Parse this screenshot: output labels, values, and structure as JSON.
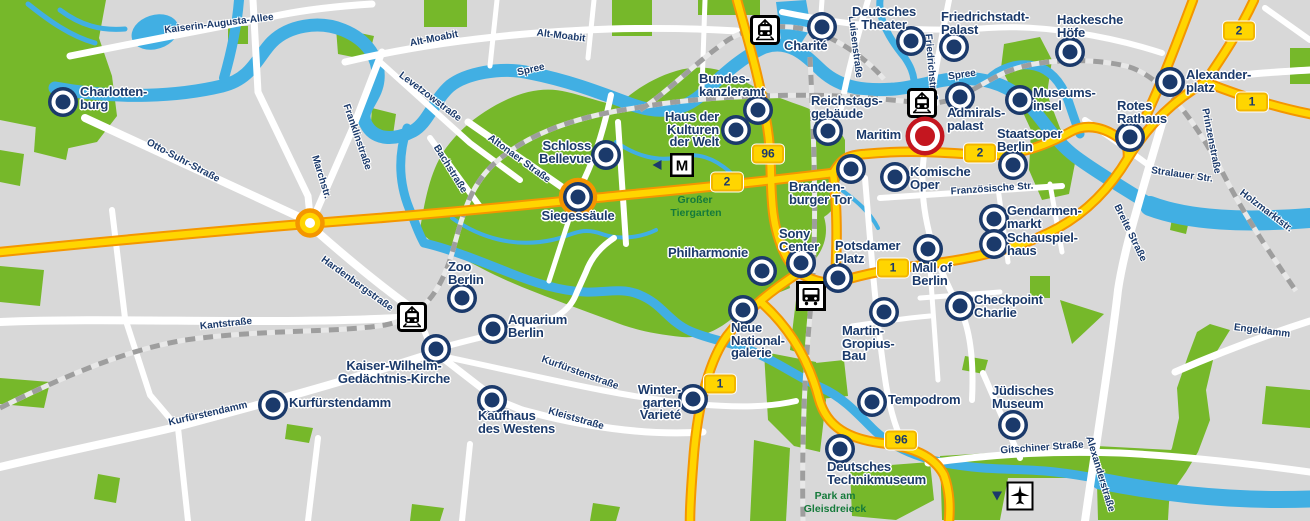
{
  "map": {
    "title": "Berlin city sightseeing map",
    "width": 1310,
    "height": 521
  },
  "colors": {
    "background": "#d8d8d8",
    "park": "#76b82a",
    "water": "#41afe3",
    "road_fill": "#ffd500",
    "road_casing": "#f49600",
    "street": "#ffffff",
    "railway": "#9e9e9e",
    "marker": "#1b3a6b",
    "marker_highlight": "#c4161f",
    "label_text": "#1b3a6b",
    "park_label": "#157a3b",
    "badge_fill": "#ffd500"
  },
  "pois": [
    {
      "id": "charlottenburg",
      "lines": [
        "Charlotten-",
        "burg"
      ],
      "marker": [
        63,
        102
      ],
      "label": [
        80,
        86
      ],
      "anchor": "left",
      "highlight": false
    },
    {
      "id": "schloss-bellevue",
      "lines": [
        "Schloss",
        "Bellevue"
      ],
      "marker": [
        606,
        155
      ],
      "label": [
        591,
        140
      ],
      "anchor": "right",
      "highlight": false
    },
    {
      "id": "siegessaeule",
      "lines": [
        "Siegessäule"
      ],
      "marker": [
        578,
        197
      ],
      "label": [
        578,
        210
      ],
      "anchor": "center",
      "highlight": false
    },
    {
      "id": "haus-der-kulturen-der-welt",
      "lines": [
        "Haus der",
        "Kulturen",
        "der Welt"
      ],
      "marker": [
        736,
        130
      ],
      "label": [
        719,
        111
      ],
      "anchor": "right",
      "highlight": false
    },
    {
      "id": "bundeskanzleramt",
      "lines": [
        "Bundes-",
        "kanzleramt"
      ],
      "marker": [
        758,
        110
      ],
      "label": [
        699,
        73
      ],
      "anchor": "left",
      "highlight": false
    },
    {
      "id": "charite",
      "lines": [
        "Charité"
      ],
      "marker": [
        822,
        27
      ],
      "label": [
        784,
        40
      ],
      "anchor": "left",
      "highlight": false
    },
    {
      "id": "deutsches-theater",
      "lines": [
        "Deutsches",
        "Theater"
      ],
      "marker": [
        911,
        41
      ],
      "label": [
        884,
        6
      ],
      "anchor": "center",
      "highlight": false
    },
    {
      "id": "friedrichstadt-palast",
      "lines": [
        "Friedrichstadt-",
        "Palast"
      ],
      "marker": [
        954,
        47
      ],
      "label": [
        941,
        11
      ],
      "anchor": "left",
      "highlight": false
    },
    {
      "id": "hackesche-hoefe",
      "lines": [
        "Hackesche",
        "Höfe"
      ],
      "marker": [
        1070,
        52
      ],
      "label": [
        1057,
        14
      ],
      "anchor": "left",
      "highlight": false
    },
    {
      "id": "reichstagsgebaeude",
      "lines": [
        "Reichstags-",
        "gebäude"
      ],
      "marker": [
        828,
        131
      ],
      "label": [
        811,
        95
      ],
      "anchor": "left",
      "highlight": false
    },
    {
      "id": "admiralspalast",
      "lines": [
        "Admirals-",
        "palast"
      ],
      "marker": [
        960,
        97
      ],
      "label": [
        947,
        107
      ],
      "anchor": "left",
      "highlight": false
    },
    {
      "id": "museumsinsel",
      "lines": [
        "Museums-",
        "insel"
      ],
      "marker": [
        1020,
        100
      ],
      "label": [
        1033,
        87
      ],
      "anchor": "left",
      "highlight": false
    },
    {
      "id": "maritim",
      "lines": [
        "Maritim"
      ],
      "marker": [
        925,
        136
      ],
      "label": [
        901,
        129
      ],
      "anchor": "right",
      "highlight": true
    },
    {
      "id": "staatsoper-berlin",
      "lines": [
        "Staatsoper",
        "Berlin"
      ],
      "marker": [
        1013,
        165
      ],
      "label": [
        997,
        128
      ],
      "anchor": "left",
      "highlight": false
    },
    {
      "id": "alexanderplatz",
      "lines": [
        "Alexander-",
        "platz"
      ],
      "marker": [
        1170,
        82
      ],
      "label": [
        1186,
        69
      ],
      "anchor": "left",
      "highlight": false
    },
    {
      "id": "rotes-rathaus",
      "lines": [
        "Rotes",
        "Rathaus"
      ],
      "marker": [
        1130,
        137
      ],
      "label": [
        1117,
        100
      ],
      "anchor": "left",
      "highlight": false
    },
    {
      "id": "brandenburger-tor",
      "lines": [
        "Branden-",
        "burger Tor"
      ],
      "marker": [
        851,
        169
      ],
      "label": [
        789,
        181
      ],
      "anchor": "left",
      "highlight": false
    },
    {
      "id": "komische-oper",
      "lines": [
        "Komische",
        "Oper"
      ],
      "marker": [
        895,
        177
      ],
      "label": [
        910,
        166
      ],
      "anchor": "left",
      "highlight": false
    },
    {
      "id": "gendarmenmarkt",
      "lines": [
        "Gendarmen-",
        "markt"
      ],
      "marker": [
        994,
        219
      ],
      "label": [
        1007,
        205
      ],
      "anchor": "left",
      "highlight": false
    },
    {
      "id": "schauspielhaus",
      "lines": [
        "Schauspiel-",
        "haus"
      ],
      "marker": [
        994,
        244
      ],
      "label": [
        1007,
        232
      ],
      "anchor": "left",
      "highlight": false
    },
    {
      "id": "sony-center",
      "lines": [
        "Sony",
        "Center"
      ],
      "marker": [
        801,
        263
      ],
      "label": [
        779,
        228
      ],
      "anchor": "left",
      "highlight": false
    },
    {
      "id": "philharmonie",
      "lines": [
        "Philharmonie"
      ],
      "marker": [
        762,
        271
      ],
      "label": [
        748,
        247
      ],
      "anchor": "right",
      "highlight": false
    },
    {
      "id": "potsdamer-platz",
      "lines": [
        "Potsdamer",
        "Platz"
      ],
      "marker": [
        838,
        278
      ],
      "label": [
        835,
        240
      ],
      "anchor": "left",
      "highlight": false
    },
    {
      "id": "mall-of-berlin",
      "lines": [
        "Mall of",
        "Berlin"
      ],
      "marker": [
        928,
        249
      ],
      "label": [
        912,
        262
      ],
      "anchor": "left",
      "highlight": false
    },
    {
      "id": "checkpoint-charlie",
      "lines": [
        "Checkpoint",
        "Charlie"
      ],
      "marker": [
        960,
        306
      ],
      "label": [
        974,
        294
      ],
      "anchor": "left",
      "highlight": false
    },
    {
      "id": "juedisches-museum",
      "lines": [
        "Jüdisches",
        "Museum"
      ],
      "marker": [
        1013,
        425
      ],
      "label": [
        992,
        385
      ],
      "anchor": "left",
      "highlight": false
    },
    {
      "id": "tempodrom",
      "lines": [
        "Tempodrom"
      ],
      "marker": [
        872,
        402
      ],
      "label": [
        888,
        394
      ],
      "anchor": "left",
      "highlight": false
    },
    {
      "id": "martin-gropius-bau",
      "lines": [
        "Martin-",
        "Gropius-",
        "Bau"
      ],
      "marker": [
        884,
        312
      ],
      "label": [
        842,
        325
      ],
      "anchor": "left",
      "highlight": false
    },
    {
      "id": "neue-nationalgalerie",
      "lines": [
        "Neue",
        "National-",
        "galerie"
      ],
      "marker": [
        743,
        310
      ],
      "label": [
        731,
        322
      ],
      "anchor": "left",
      "highlight": false
    },
    {
      "id": "deutsches-technikmuseum",
      "lines": [
        "Deutsches",
        "Technikmuseum"
      ],
      "marker": [
        840,
        449
      ],
      "label": [
        827,
        461
      ],
      "anchor": "left",
      "highlight": false
    },
    {
      "id": "wintergarten-variete",
      "lines": [
        "Winter-",
        "garten",
        "Varieté"
      ],
      "marker": [
        693,
        399
      ],
      "label": [
        681,
        384
      ],
      "anchor": "right",
      "highlight": false
    },
    {
      "id": "zoo-berlin",
      "lines": [
        "Zoo",
        "Berlin"
      ],
      "marker": [
        462,
        298
      ],
      "label": [
        448,
        261
      ],
      "anchor": "left",
      "highlight": false
    },
    {
      "id": "aquarium-berlin",
      "lines": [
        "Aquarium",
        "Berlin"
      ],
      "marker": [
        493,
        329
      ],
      "label": [
        508,
        314
      ],
      "anchor": "left",
      "highlight": false
    },
    {
      "id": "kaiser-wilhelm-gedaechtnis-kirche",
      "lines": [
        "Kaiser-Wilhelm-",
        "Gedächtnis-Kirche"
      ],
      "marker": [
        436,
        349
      ],
      "label": [
        394,
        360
      ],
      "anchor": "center",
      "highlight": false
    },
    {
      "id": "kurfuerstendamm",
      "lines": [
        "Kurfürstendamm"
      ],
      "marker": [
        273,
        405
      ],
      "label": [
        289,
        397
      ],
      "anchor": "left",
      "highlight": false
    },
    {
      "id": "kaufhaus-des-westens",
      "lines": [
        "Kaufhaus",
        "des Westens"
      ],
      "marker": [
        492,
        400
      ],
      "label": [
        478,
        410
      ],
      "anchor": "left",
      "highlight": false
    }
  ],
  "street_labels": [
    {
      "text": "Kaiserin-Augusta-Allee",
      "x": 219,
      "y": 24,
      "angle": -7,
      "kind": "street"
    },
    {
      "text": "Alt-Moabit",
      "x": 434,
      "y": 39,
      "angle": -11,
      "kind": "street"
    },
    {
      "text": "Alt-Moabit",
      "x": 561,
      "y": 36,
      "angle": 7,
      "kind": "street"
    },
    {
      "text": "Levetzowstraße",
      "x": 430,
      "y": 97,
      "angle": 37,
      "kind": "street"
    },
    {
      "text": "Otto-Suhr-Straße",
      "x": 183,
      "y": 161,
      "angle": 28,
      "kind": "street"
    },
    {
      "text": "Marchstr.",
      "x": 321,
      "y": 177,
      "angle": 73,
      "kind": "street"
    },
    {
      "text": "Franklinstraße",
      "x": 357,
      "y": 137,
      "angle": 71,
      "kind": "street"
    },
    {
      "text": "Bachstraße",
      "x": 450,
      "y": 169,
      "angle": 58,
      "kind": "street"
    },
    {
      "text": "Altonaer Straße",
      "x": 519,
      "y": 159,
      "angle": 36,
      "kind": "street"
    },
    {
      "text": "Spree",
      "x": 531,
      "y": 70,
      "angle": -13,
      "kind": "water"
    },
    {
      "text": "Spree",
      "x": 962,
      "y": 75,
      "angle": -8,
      "kind": "water"
    },
    {
      "text": "Hardenbergstraße",
      "x": 357,
      "y": 284,
      "angle": 36,
      "kind": "street"
    },
    {
      "text": "Kantstraße",
      "x": 226,
      "y": 324,
      "angle": -6,
      "kind": "street"
    },
    {
      "text": "Kurfürstendamm",
      "x": 208,
      "y": 414,
      "angle": -13,
      "kind": "street"
    },
    {
      "text": "Kurfürstenstraße",
      "x": 580,
      "y": 373,
      "angle": 20,
      "kind": "street"
    },
    {
      "text": "Kleiststraße",
      "x": 576,
      "y": 419,
      "angle": 16,
      "kind": "street"
    },
    {
      "text": "Luisenstraße",
      "x": 855,
      "y": 47,
      "angle": 83,
      "kind": "street"
    },
    {
      "text": "Friedrichstraße",
      "x": 931,
      "y": 70,
      "angle": 85,
      "kind": "street"
    },
    {
      "text": "Französische Str.",
      "x": 992,
      "y": 189,
      "angle": -4,
      "kind": "street"
    },
    {
      "text": "Stralauer Str.",
      "x": 1182,
      "y": 175,
      "angle": 8,
      "kind": "street"
    },
    {
      "text": "Holzmarktstr.",
      "x": 1266,
      "y": 211,
      "angle": 37,
      "kind": "street"
    },
    {
      "text": "Prinzenstraße",
      "x": 1211,
      "y": 141,
      "angle": 79,
      "kind": "street"
    },
    {
      "text": "Breite Straße",
      "x": 1130,
      "y": 233,
      "angle": 64,
      "kind": "street"
    },
    {
      "text": "Engeldamm",
      "x": 1262,
      "y": 331,
      "angle": 7,
      "kind": "street"
    },
    {
      "text": "Gitschiner Straße",
      "x": 1042,
      "y": 448,
      "angle": -4,
      "kind": "street"
    },
    {
      "text": "Alexanderstraße",
      "x": 1100,
      "y": 474,
      "angle": 73,
      "kind": "street"
    },
    {
      "text": "Großer",
      "x": 695,
      "y": 200,
      "angle": 0,
      "kind": "park"
    },
    {
      "text": "Tiergarten",
      "x": 696,
      "y": 213,
      "angle": 0,
      "kind": "park"
    },
    {
      "text": "Park am",
      "x": 835,
      "y": 496,
      "angle": 0,
      "kind": "park"
    },
    {
      "text": "Gleisdreieck",
      "x": 835,
      "y": 509,
      "angle": 0,
      "kind": "park"
    }
  ],
  "road_badges": [
    {
      "number": "96",
      "x": 768,
      "y": 154
    },
    {
      "number": "2",
      "x": 727,
      "y": 182
    },
    {
      "number": "2",
      "x": 980,
      "y": 153
    },
    {
      "number": "2",
      "x": 1239,
      "y": 31
    },
    {
      "number": "1",
      "x": 1252,
      "y": 102
    },
    {
      "number": "1",
      "x": 893,
      "y": 268
    },
    {
      "number": "1",
      "x": 720,
      "y": 384
    },
    {
      "number": "96",
      "x": 901,
      "y": 440
    }
  ],
  "transport_icons": [
    {
      "type": "s-bahn-station-icon",
      "x": 765,
      "y": 30
    },
    {
      "type": "s-bahn-station-icon",
      "x": 922,
      "y": 103
    },
    {
      "type": "s-bahn-station-icon",
      "x": 412,
      "y": 317
    },
    {
      "type": "metro-station-icon",
      "x": 682,
      "y": 165
    },
    {
      "type": "bus-station-icon",
      "x": 811,
      "y": 296
    },
    {
      "type": "airport-icon",
      "x": 1020,
      "y": 496
    },
    {
      "type": "triangle-left-icon",
      "x": 657,
      "y": 165
    },
    {
      "type": "triangle-down-icon",
      "x": 997,
      "y": 496
    }
  ]
}
